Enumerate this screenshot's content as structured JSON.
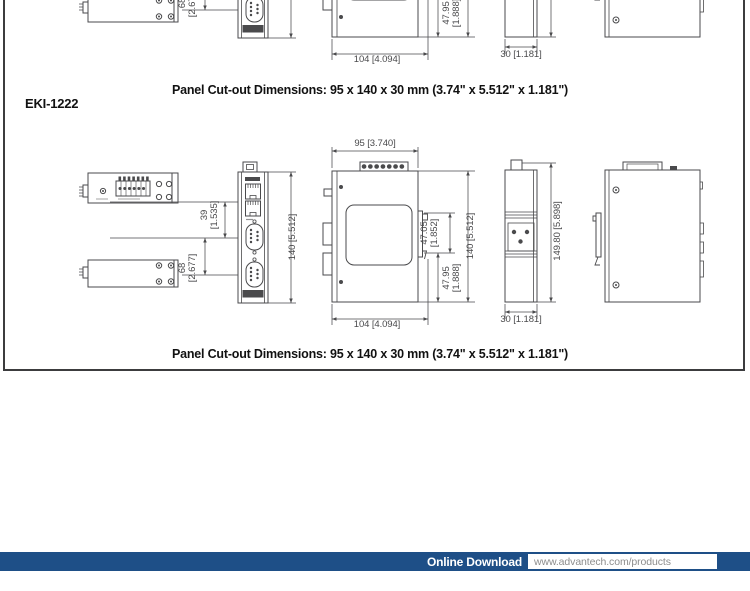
{
  "page": {
    "captions": {
      "panel_cutout": "Panel Cut-out Dimensions: 95 x 140 x 30 mm (3.74\" x 5.512\" x 1.181\")",
      "model": "EKI-1222"
    },
    "dims": {
      "width_top": "95 [3.740]",
      "width_overall": "104 [4.094]",
      "height_body": "140 [5.512]",
      "height_overall": "149.80 [5.898]",
      "depth": "30 [1.181]",
      "offset_a_mm": "39",
      "offset_a_in": "[1.535]",
      "offset_b_mm": "68",
      "offset_b_in": "[2.677]",
      "clip_a_mm": "47.05",
      "clip_a_in": "[1.852]",
      "clip_b_mm": "47.95",
      "clip_b_in": "[1.888]"
    },
    "footer": {
      "label": "Online Download",
      "url": "www.advantech.com/products"
    },
    "colors": {
      "footer_bar": "#1e4f87",
      "drawing_line": "#4a4a4c"
    }
  }
}
